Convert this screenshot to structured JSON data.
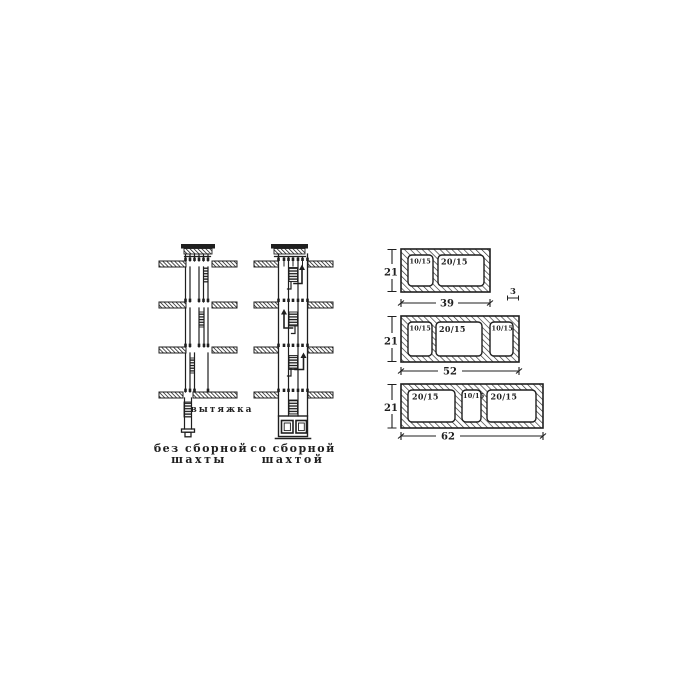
{
  "figure": {
    "left_shaft": {
      "exhaust_label": "вытяжка",
      "caption": [
        "без сборной",
        "шахты"
      ]
    },
    "right_shaft": {
      "caption": [
        "со сборной",
        "шахтой"
      ]
    },
    "blocks": [
      {
        "height": "21",
        "width": "39",
        "wall_thickness": "3",
        "openings": [
          "10/15",
          "20/15"
        ]
      },
      {
        "height": "21",
        "width": "52",
        "openings": [
          "10/15",
          "20/15",
          "10/15"
        ]
      },
      {
        "height": "21",
        "width": "62",
        "openings": [
          "20/15",
          "10/15",
          "20/15"
        ]
      }
    ],
    "colors": {
      "ink": "#1f1f1f",
      "paper": "#ffffff"
    }
  }
}
